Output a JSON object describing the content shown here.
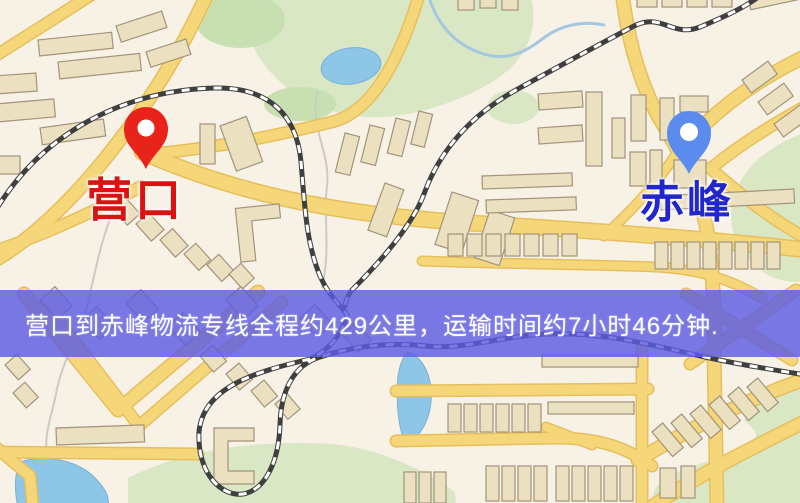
{
  "markers": [
    {
      "id": "yingkou",
      "label": "营口",
      "pin_color": "#e8231a",
      "label_color": "#d91312"
    },
    {
      "id": "chifeng",
      "label": "赤峰",
      "pin_color": "#5b8ced",
      "label_color": "#2126cd"
    }
  ],
  "banner": {
    "text": "营口到赤峰物流专线全程约429公里，运输时间约7小时46分钟.",
    "background": "rgba(92,92,226,0.82)",
    "text_color": "#ffffff"
  },
  "theme": {
    "map-bg": "#f8f2e6",
    "road": "#f5d77a",
    "road-casing": "#e6bf5c",
    "building": "#ebe1c1",
    "park": "#d9e7c5",
    "water": "#8ec6e8",
    "railway": "#3f3f3f",
    "pin-red": "#e8231a",
    "pin-blue": "#5b8ced",
    "label-red": "#d91312",
    "label-blue": "#2126cd",
    "banner-bg": "rgba(92,92,226,0.82)",
    "banner-text": "#ffffff"
  }
}
